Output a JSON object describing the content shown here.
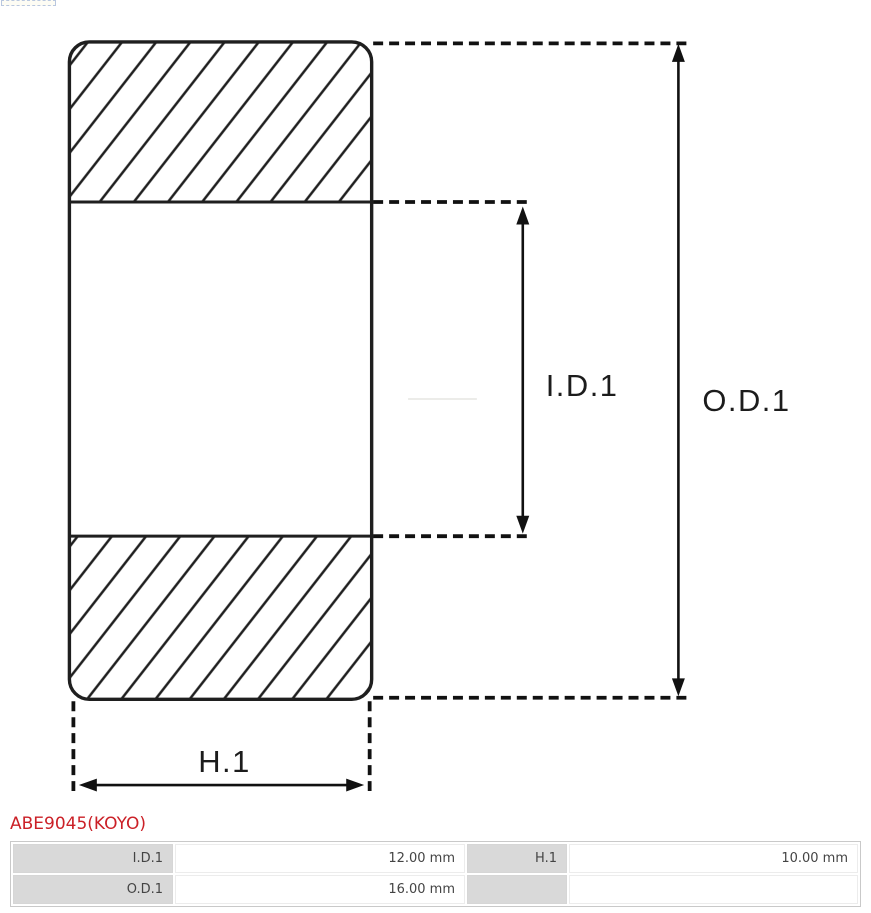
{
  "drawing": {
    "id_label": "I.D.1",
    "od_label": "O.D.1",
    "h_label": "H.1"
  },
  "part_number": "ABE9045(KOYO)",
  "spec_table": {
    "rows": [
      {
        "c0_label": "I.D.1",
        "c1_value": "12.00 mm",
        "c2_label": "H.1",
        "c3_value": "10.00 mm"
      },
      {
        "c0_label": "O.D.1",
        "c1_value": "16.00 mm",
        "c2_label": "",
        "c3_value": ""
      }
    ]
  },
  "colors": {
    "drawing_line": "#1f1f1f",
    "part_number_red": "#cb2027",
    "table_label_bg": "#d9d9d9",
    "table_border": "#c9c9c9",
    "table_text": "#444444"
  }
}
